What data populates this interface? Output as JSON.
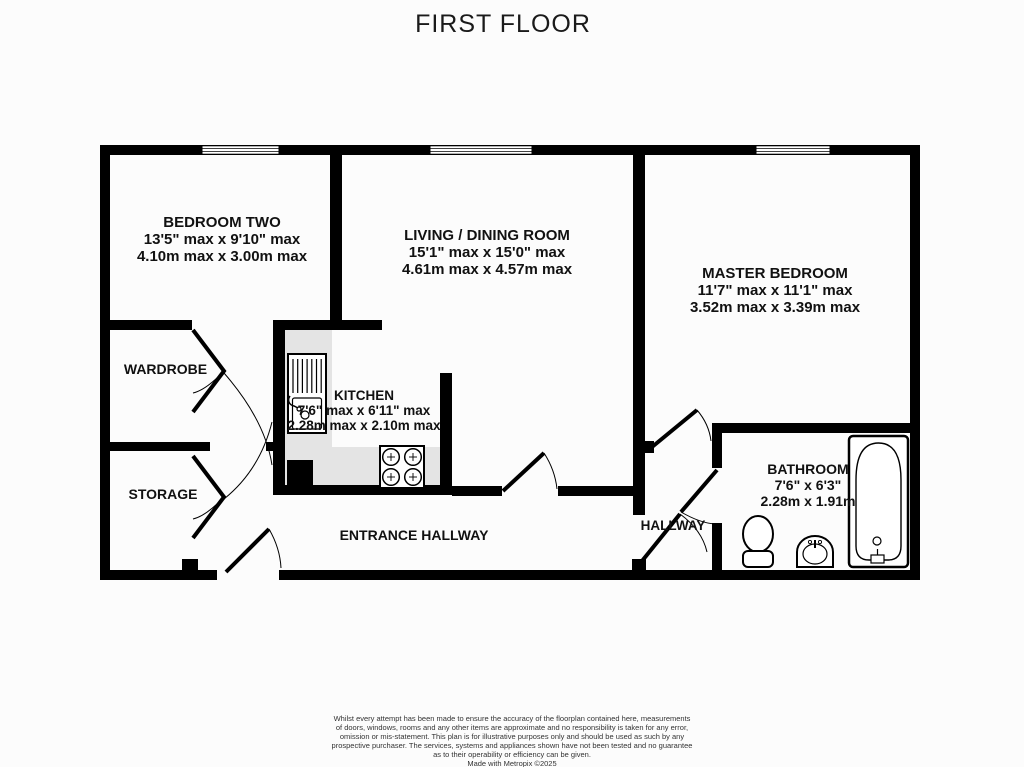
{
  "title": "FIRST FLOOR",
  "rooms": {
    "bedroom_two": {
      "name": "BEDROOM TWO",
      "dims_imperial": "13'5\" max x 9'10\" max",
      "dims_metric": "4.10m max x 3.00m max"
    },
    "living_dining": {
      "name": "LIVING / DINING ROOM",
      "dims_imperial": "15'1\" max x 15'0\" max",
      "dims_metric": "4.61m max x 4.57m max"
    },
    "master_bedroom": {
      "name": "MASTER BEDROOM",
      "dims_imperial": "11'7\" max x 11'1\" max",
      "dims_metric": "3.52m max x 3.39m max"
    },
    "kitchen": {
      "name": "KITCHEN",
      "dims_imperial": "7'6\" max x 6'11\" max",
      "dims_metric": "2.28m max x 2.10m max"
    },
    "bathroom": {
      "name": "BATHROOM",
      "dims_imperial": "7'6\"  x 6'3\"",
      "dims_metric": "2.28m  x 1.91m"
    },
    "wardrobe": {
      "name": "WARDROBE"
    },
    "storage": {
      "name": "STORAGE"
    },
    "entrance_hallway": {
      "name": "ENTRANCE HALLWAY"
    },
    "hallway": {
      "name": "HALLWAY"
    }
  },
  "footer": {
    "lines": [
      "Whilst every attempt has been made to ensure the accuracy of the floorplan contained here, measurements",
      "of doors, windows, rooms and any other items are approximate and no responsibility is taken for any error,",
      "omission or mis-statement. This plan is for illustrative purposes only and should be used as such by any",
      "prospective purchaser. The services, systems and appliances shown have not been tested and no guarantee",
      "as to their operability or efficiency can be given."
    ],
    "credit": "Made with Metropix ©2025"
  },
  "colors": {
    "wall": "#000000",
    "kitchen_floor": "#e4e4e4",
    "background": "#fcfcfc",
    "text": "#111111"
  }
}
